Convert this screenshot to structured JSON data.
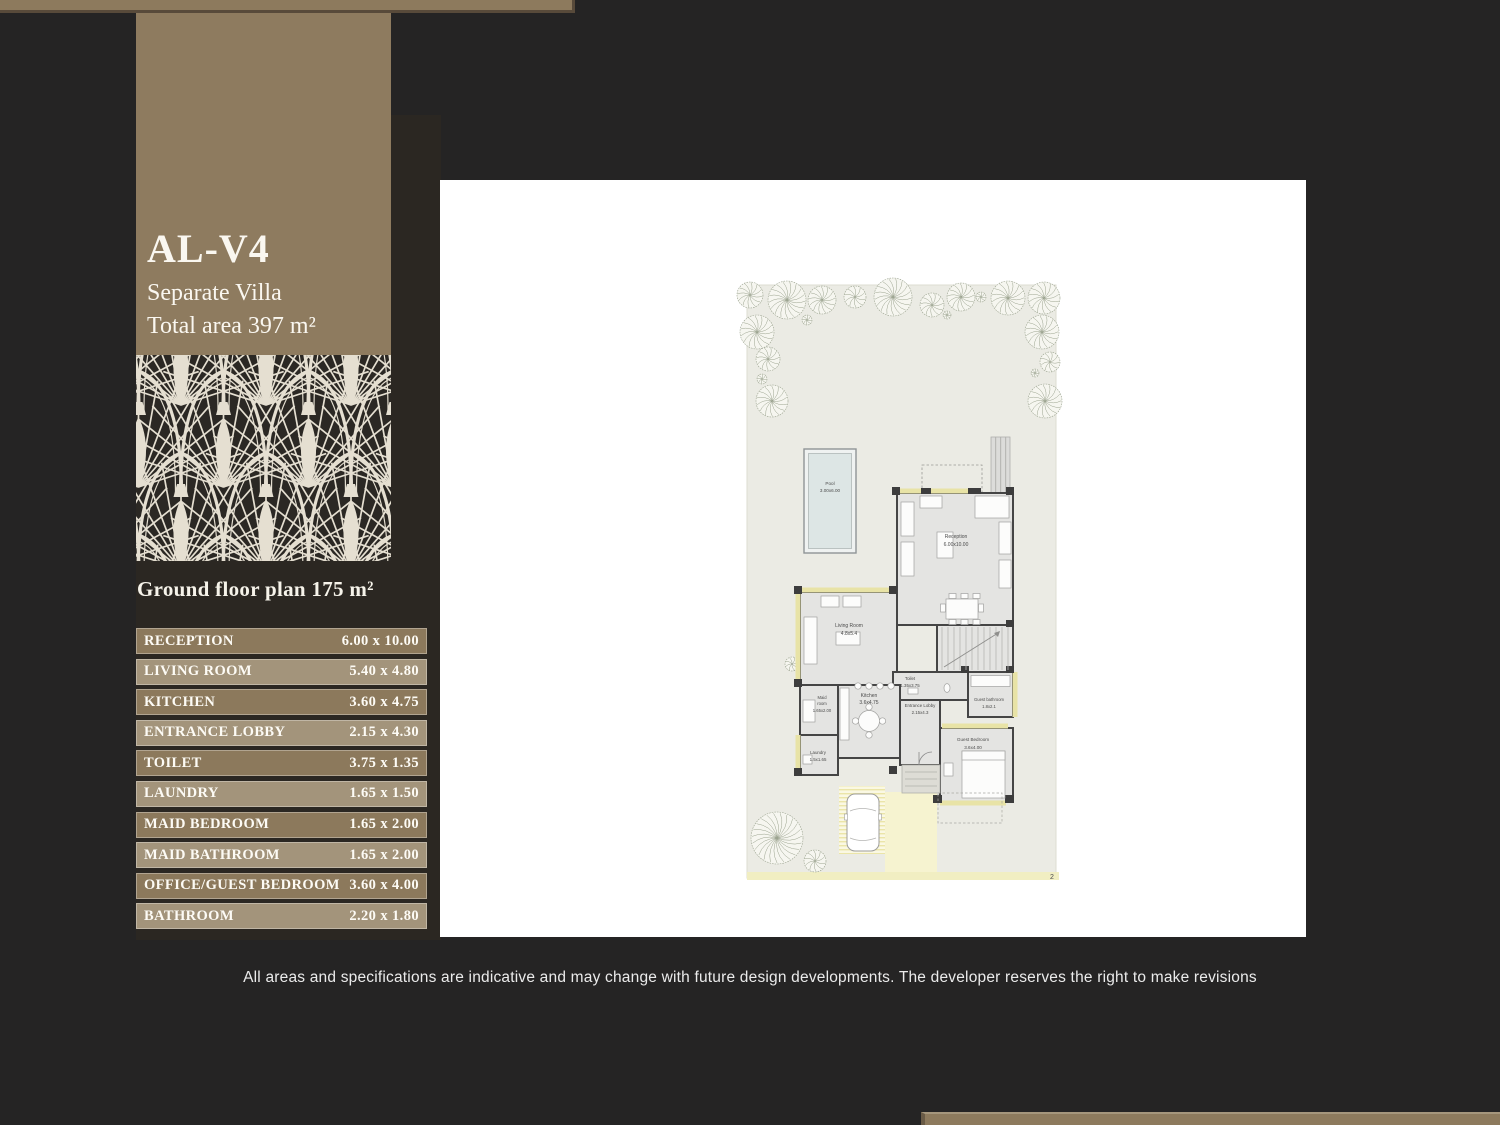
{
  "page": {
    "disclaimer": "All areas and specifications are indicative and may change with future design developments. The developer reserves the right to make revisions"
  },
  "sidebar": {
    "unit_code": "AL-V4",
    "unit_type": "Separate Villa",
    "total_area": "Total area 397 m²",
    "floor_title": "Ground floor plan 175 m²",
    "rooms": [
      {
        "name": "RECEPTION",
        "dims": "6.00 x 10.00"
      },
      {
        "name": "LIVING ROOM",
        "dims": "5.40 x 4.80"
      },
      {
        "name": "KITCHEN",
        "dims": "3.60 x 4.75"
      },
      {
        "name": "ENTRANCE LOBBY",
        "dims": "2.15 x 4.30"
      },
      {
        "name": "TOILET",
        "dims": "3.75 x 1.35"
      },
      {
        "name": "LAUNDRY",
        "dims": "1.65 x 1.50"
      },
      {
        "name": "MAID BEDROOM",
        "dims": "1.65 x 2.00"
      },
      {
        "name": "MAID BATHROOM",
        "dims": "1.65 x 2.00"
      },
      {
        "name": "OFFICE/GUEST BEDROOM",
        "dims": "3.60 x 4.00"
      },
      {
        "name": "BATHROOM",
        "dims": "2.20 x 1.80"
      }
    ]
  },
  "plan": {
    "page_number": "2",
    "labels": {
      "pool": [
        "Pool",
        "3.00x6.00"
      ],
      "reception": [
        "Reception",
        "6.00x10.00"
      ],
      "living_room": [
        "Living Room",
        "4.8x5.4"
      ],
      "kitchen": [
        "Kitchen",
        "3.6x4.75"
      ],
      "entrance_lobby": [
        "Entrance Lobby",
        "2.15x4.3"
      ],
      "toilet": [
        "Toilet",
        "1.35x3.75"
      ],
      "laundry": [
        "Laundry",
        "1.5x1.65"
      ],
      "maid_room": [
        "Maid",
        "room",
        "1.65x2.00"
      ],
      "guest_bathroom": [
        "Guest bathroom",
        "1.8x2.1"
      ],
      "guest_bedroom": [
        "Guest Bedroom",
        "3.6x4.00"
      ]
    },
    "trees": [
      [
        310,
        115,
        13
      ],
      [
        347,
        120,
        19
      ],
      [
        382,
        120,
        14
      ],
      [
        415,
        117,
        11
      ],
      [
        453,
        117,
        19
      ],
      [
        492,
        125,
        12
      ],
      [
        521,
        117,
        14
      ],
      [
        541,
        117,
        5
      ],
      [
        568,
        118,
        17
      ],
      [
        604,
        118,
        16
      ],
      [
        317,
        152,
        17
      ],
      [
        328,
        179,
        12
      ],
      [
        322,
        199,
        5
      ],
      [
        332,
        221,
        16
      ],
      [
        602,
        152,
        17
      ],
      [
        610,
        182,
        10
      ],
      [
        595,
        193,
        4
      ],
      [
        605,
        221,
        17
      ],
      [
        337,
        658,
        26
      ],
      [
        375,
        681,
        11
      ],
      [
        367,
        140,
        5
      ],
      [
        507,
        135,
        4
      ],
      [
        352,
        484,
        7
      ]
    ],
    "colors": {
      "accent_brown": "#8d7a5d",
      "header_band": "#8e7b5f",
      "row_dark": "#8c795c",
      "row_light": "#a3947b",
      "pattern_cream": "#e5dfd1",
      "page_background": "#252424",
      "plot_fill": "#ebebe4",
      "wall": "#454545",
      "sill_yellow": "#e8e3a6",
      "driveway_yellow": "#f6f3d0"
    }
  }
}
